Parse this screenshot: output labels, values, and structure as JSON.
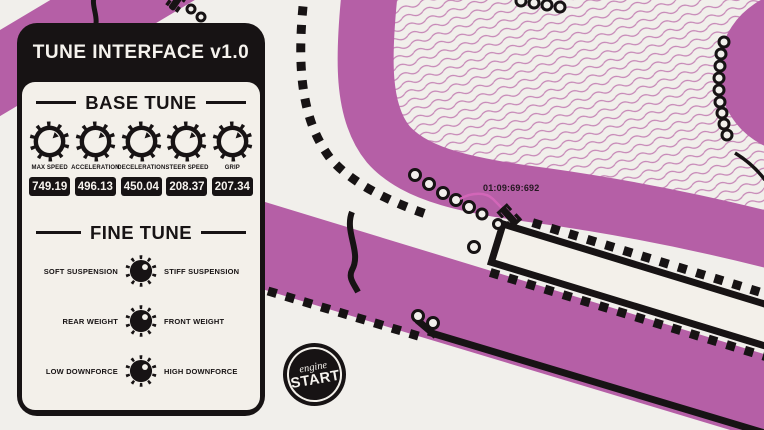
{
  "app": {
    "title": "TUNE INTERFACE v1.0"
  },
  "base_tune": {
    "heading": "BASE TUNE",
    "knobs": [
      {
        "label": "MAX SPEED",
        "value": "749.19"
      },
      {
        "label": "ACCELERATION",
        "value": "496.13"
      },
      {
        "label": "DECELERATION",
        "value": "450.04"
      },
      {
        "label": "STEER SPEED",
        "value": "208.37"
      },
      {
        "label": "GRIP",
        "value": "207.34"
      }
    ]
  },
  "fine_tune": {
    "heading": "FINE TUNE",
    "rows": [
      {
        "left": "SOFT SUSPENSION",
        "right": "STIFF SUSPENSION"
      },
      {
        "left": "REAR WEIGHT",
        "right": "FRONT WEIGHT"
      },
      {
        "left": "LOW DOWNFORCE",
        "right": "HIGH DOWNFORCE"
      }
    ]
  },
  "start_button": {
    "line1": "engine",
    "line2": "START"
  },
  "track": {
    "lap_timer": "01:09:69:692"
  },
  "colors": {
    "track": "#b55fa6",
    "panel": "#171314",
    "panel_bg": "#f3f0ea",
    "background": "#f1efeb",
    "pattern_line": "#c584b5",
    "trail": "#d266b8",
    "text_light": "#f6f3ee",
    "timer_text": "#241721"
  }
}
